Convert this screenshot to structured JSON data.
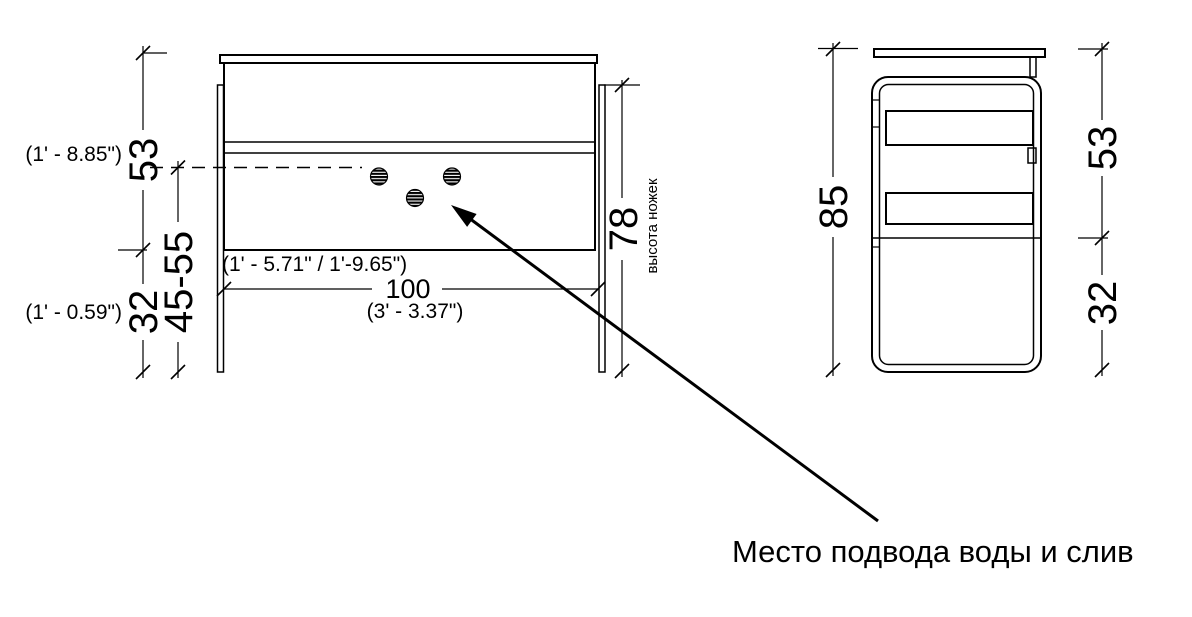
{
  "drawing": {
    "annotation_label": "Место подвода воды и слив",
    "front_view": {
      "height_top": "53",
      "height_top_imperial": "(1' - 8.85\")",
      "height_shelf_range": "45-55",
      "height_bottom": "32",
      "height_bottom_imperial": "(1' - 0.59\")",
      "legs_height": "78",
      "legs_height_note": "высота ножек",
      "width": "100",
      "width_imperial": "(3' - 3.37\")",
      "shelf_range_imperial": "(1' - 5.71\" / 1'-9.65\")"
    },
    "side_view": {
      "total_height": "85",
      "upper_height": "53",
      "lower_height": "32"
    },
    "colors": {
      "line": "#000000",
      "background": "#ffffff"
    }
  }
}
